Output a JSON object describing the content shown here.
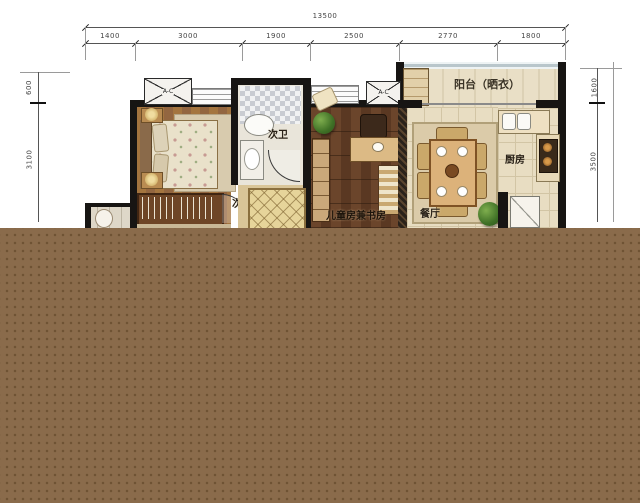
{
  "dimensions": {
    "total": "13500",
    "top": [
      "1400",
      "3000",
      "1900",
      "2500",
      "2770",
      "1800"
    ],
    "left": [
      "600",
      "3100"
    ],
    "right": [
      "1600",
      "3500"
    ]
  },
  "rooms": {
    "balcony": "阳台（晒衣）",
    "bathroom": "次卫",
    "bedroom": "次卧",
    "kids_study": "儿童房兼书房",
    "dining": "餐厅",
    "kitchen": "厨房"
  },
  "labels": {
    "ac": "A-C"
  },
  "colors": {
    "overlay_brown": "#8a6b4b",
    "wall": "#171513",
    "bedroom_wood": "#9a6b42",
    "kids_wood": "#5f3d26",
    "tile_beige": "#e8ddc2",
    "dim_text": "#444444"
  }
}
